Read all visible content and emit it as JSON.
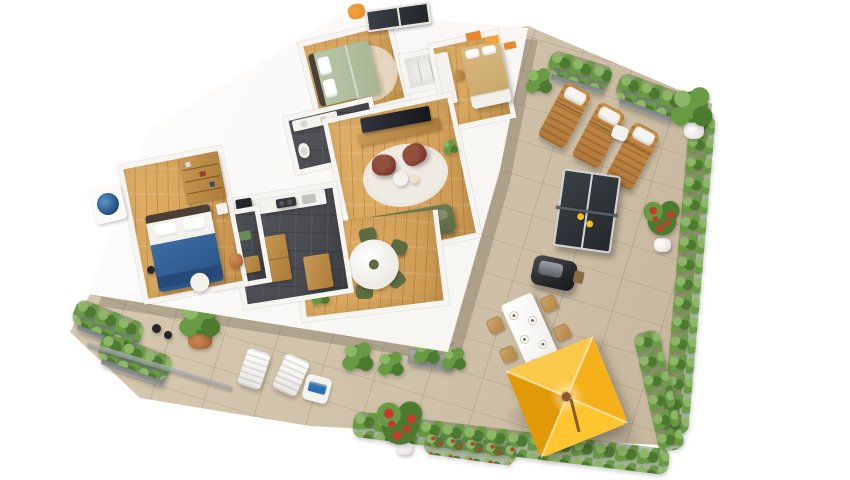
{
  "scene": {
    "description": "Photorealistic 3D isometric render of a furnished three-bedroom apartment floor plan with a large wrap-around roof terrace, viewed from above on a white background",
    "background": "#ffffff",
    "visible_text": ""
  },
  "colors": {
    "wall": "#f7f5f1",
    "wall_shadow": "#dcd7d0",
    "wood": "#d7a55c",
    "slate": "#4b4c51",
    "terrace": "#cfc1a8",
    "leaf_light": "#8cb765",
    "leaf_mid": "#699a44",
    "leaf_dark": "#4c7a2f",
    "flower_red": "#c6392c",
    "umbrella_bright": "#ffc531",
    "umbrella_mid": "#f5b01a",
    "umbrella_deep": "#e19a05",
    "umbrella_pale": "#fbc94a",
    "sofa_green": "#6f7c4f",
    "armchair_red": "#7e3a2e",
    "rug_white": "#efeae2",
    "bed_green": "#b9c8a9",
    "bed_beige": "#d8b97f",
    "bed_blue": "#2f5d92",
    "headboard_dark": "#4a4038",
    "white_furn": "#f4f2ee",
    "lounger_wood": "#c98c44",
    "pingpong": "#2e3237",
    "grill_black": "#2a2b2d",
    "pot_terracotta": "#b97142",
    "pot_white": "#eceae6",
    "towel_blue": "#2f6fae",
    "art_orange": "#e8872b",
    "art_blue": "#1f4d7a",
    "chair_olive": "#5d6b43",
    "outdoor_chair_wood": "#b9853f",
    "railing": "#aeb4b6"
  },
  "apartment": {
    "rooms": [
      {
        "id": "bedroom-green",
        "label": "bedroom with sage-green double bed, round rug and window",
        "floor": "wood"
      },
      {
        "id": "wardrobe-closet",
        "label": "built-in wardrobe between bedrooms",
        "floor": "white"
      },
      {
        "id": "bedroom-kids",
        "label": "bedroom with beige bed, drawer base, white desk, wooden chair and orange wall art",
        "floor": "wood"
      },
      {
        "id": "bathroom-top",
        "label": "bathroom with slate floor, vanity, toilet and shower",
        "floor": "slate"
      },
      {
        "id": "living-room",
        "label": "living room with TV console, white rug, two burgundy armchairs, coffee table, olive-green sofa and plant",
        "floor": "wood"
      },
      {
        "id": "dining-area",
        "label": "dining area with round white table, olive chairs and potted plant",
        "floor": "wood"
      },
      {
        "id": "kitchen",
        "label": "kitchen with slate floor, white counter, coffee machine, cooktop, wooden island and tall cabinet",
        "floor": "slate"
      },
      {
        "id": "bathroom-small",
        "label": "second bathroom with bathtub, green mat and wooden shelf",
        "floor": "slate"
      },
      {
        "id": "bedroom-blue",
        "label": "master bedroom with blue-and-white double bed, wooden bookshelf, floor lamp, pouf, terracotta stool and round blue wall art",
        "floor": "wood"
      }
    ]
  },
  "terrace": {
    "label": "wrap-around roof terrace with beige stone tiles",
    "items": [
      {
        "id": "sun-loungers",
        "count": 3,
        "material": "wood with white head cushions"
      },
      {
        "id": "lounger-side-table",
        "count": 1
      },
      {
        "id": "ping-pong-table",
        "count": 1,
        "paddles": 2
      },
      {
        "id": "bbq-grill",
        "count": 1
      },
      {
        "id": "outdoor-dining-set",
        "table": 1,
        "chairs": 6,
        "place_settings": 5
      },
      {
        "id": "yellow-parasol",
        "count": 1,
        "panels": 4
      },
      {
        "id": "white-deck-chairs",
        "count": 2
      },
      {
        "id": "towel-side-table",
        "count": 1,
        "towel_color": "blue"
      },
      {
        "id": "rose-bush-pots",
        "count": 2
      },
      {
        "id": "terracotta-potted-plant",
        "count": 1
      },
      {
        "id": "small-dark-pots",
        "count": 2
      },
      {
        "id": "white-potted-plant-corner",
        "count": 1
      },
      {
        "id": "hedge-planters",
        "count": 8
      },
      {
        "id": "glass-railings",
        "count": 2
      }
    ]
  }
}
